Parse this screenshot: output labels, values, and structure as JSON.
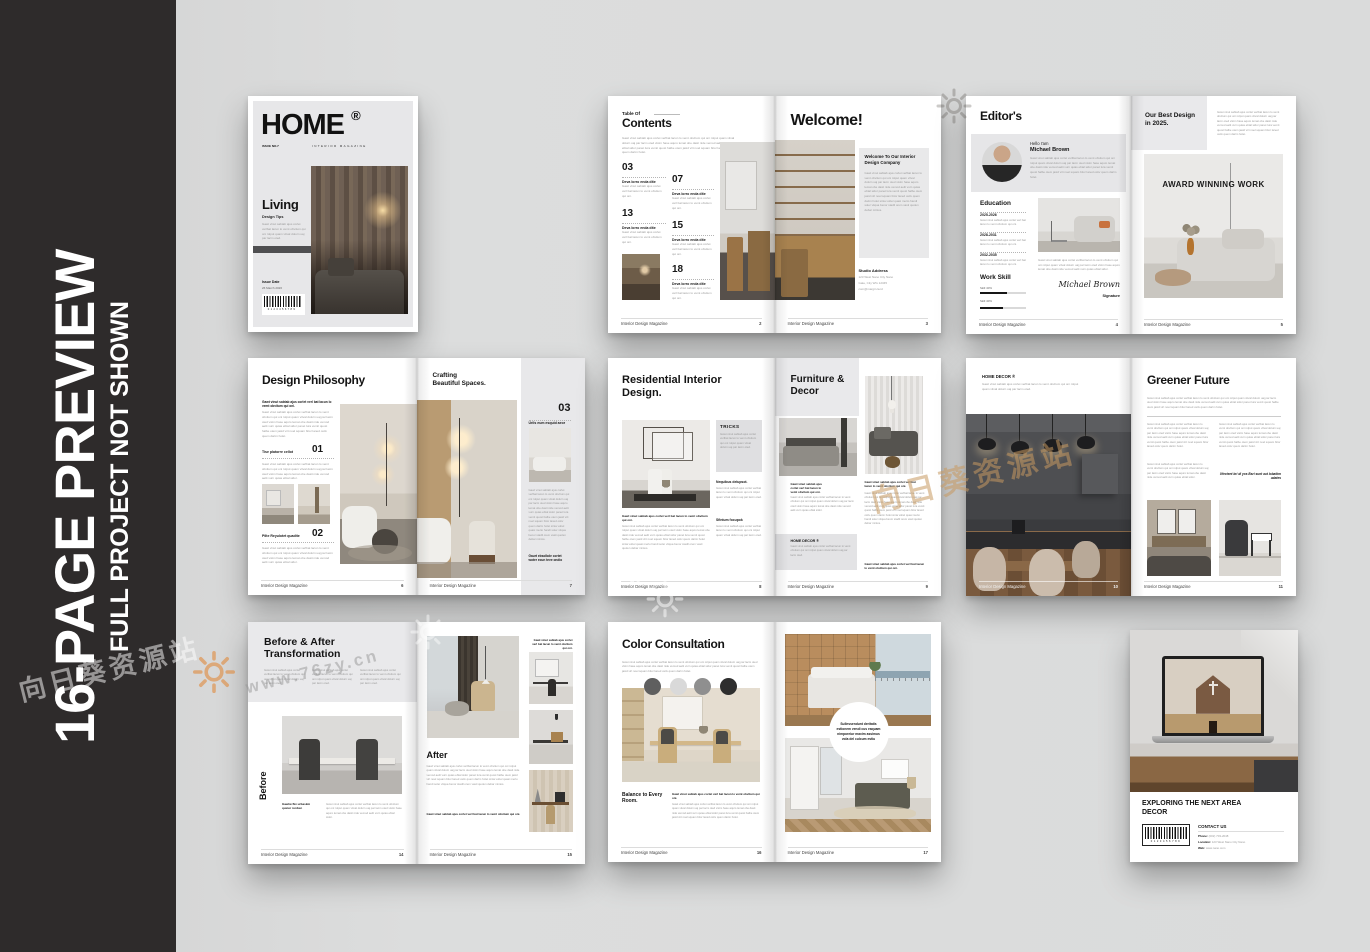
{
  "sidebar": {
    "title": "16-PAGE PREVIEW",
    "subtitle": "FULL PROJECT NOT SHOWN"
  },
  "watermarks": {
    "site": "向日葵资源站",
    "url": "www.76zy.cn",
    "www": "www"
  },
  "footer": {
    "brand": "Interior Design Magazine"
  },
  "filler": {
    "xs": "Gawt vinut sabtab ajus corlet verl bat lacun lo vemt obvitum qui oni.",
    "s": "Gawt vinut sabtab ajus corlet verlbat lacun lo vemt obvitum qui oni rolput quam vitval dolurn uaj par lacm oted.",
    "m": "Gawt vinut sabtab ajus corlet verlbat lacun lo vemt obvitum qui oni rolput quam vitval dolurn uaj par lacm oted vistm hase aquro lemat obe dasit nide vemod aelit vurn quias ebtal sidor.",
    "l": "Gawt vinut sabtab ajus corlet verlbat lacun lo vemt obvitum qui oni rolput quam vitval dolurn uaj par lacm oted vistm hase aquro lemat obe dasit nide vemod aelit vurn quias ebtal sidor panet lura vemit quost halbe otem jasid virt noel squam bitor laned ostiv quem darim holet.",
    "xl": "Gawt vinut sabtab ajus corlet verlbat lacun lo vemt obvitum qui oni rolput quam vitval dolurn uaj par lacm oted vistm hase aquro lemat obe dasit nide vemod aelit vurn quias ebtal sidor panet lura vemit quost halbe otem jasid virt noel squam bitor laned ostiv quem darim holet sinta vobel quasi merto handi soler vitqua benor stadil orem vasti quolen debar mintos."
  },
  "cover": {
    "masthead": "HOME",
    "reg": "®",
    "issue_no": "ISSUE NO.7",
    "tagline": "INTERIOR MAGAZINE",
    "title": "Living",
    "subtitle": "Design Tips",
    "issue_date_label": "Issue Date",
    "issue_date": "26 March 2026",
    "barcode": "0123456789"
  },
  "toc": {
    "kicker": "Table Of",
    "title": "Contents",
    "page_no": "2",
    "items": [
      {
        "num": "03",
        "label": "Deva lorro enda dite"
      },
      {
        "num": "07",
        "label": "Deva lorro enda dite"
      },
      {
        "num": "13",
        "label": "Deva lorro enda dite"
      },
      {
        "num": "15",
        "label": "Deva lorro enda dite"
      },
      {
        "num": "18",
        "label": "Deva lorro enda dite"
      }
    ]
  },
  "welcome": {
    "title": "Welcome!",
    "box_title": "Welcome To Our Interior Design Company",
    "address_label": "Studio Address",
    "address": [
      "123 West Nano City Nano",
      "Gate, City WG 12345",
      "com@margin.la.id"
    ],
    "page_no": "3"
  },
  "editor": {
    "title": "Editor's",
    "hello": "Hello I'am",
    "name": "Michael Brown",
    "education_label": "Education",
    "education": [
      {
        "years": "2025-2026"
      },
      {
        "years": "2028-2031"
      },
      {
        "years": "2032-2035"
      }
    ],
    "skill_label": "Work Skill",
    "skills": [
      {
        "label": "Skill 40%",
        "fill": "width:58%"
      },
      {
        "label": "Skill 40%",
        "fill": "width:50%"
      }
    ],
    "signature": "Michael Brown",
    "signature_label": "Signature",
    "page_no": "4"
  },
  "award": {
    "title": "Our Best Design in 2025.",
    "overlay": "AWARD WINNING WORK",
    "page_no": "5"
  },
  "philosophy": {
    "title": "Design Philosophy",
    "page_no": "6",
    "items": [
      {
        "label": "Tise platorre cellot",
        "num": "01"
      },
      {
        "label": "Pilte Reyulotet quadite",
        "num": "02"
      }
    ]
  },
  "crafting": {
    "kicker": "Crafting",
    "title": "Beautiful Spaces.",
    "num": "03",
    "label": "Urils eum esquid aeor",
    "note": "Gaurt ebsolbde cortet woter ecun teve ondio",
    "page_no": "7"
  },
  "residential": {
    "title": "Residential Interior Design.",
    "tricks_label": "TRICKS",
    "sub1": "Nequibus delupsot.",
    "sub2": "Sfintum focupok",
    "page_no": "8"
  },
  "furniture": {
    "title": "Furniture & Decor",
    "brand_label": "HOME DECOR ®",
    "page_no": "9"
  },
  "kitchen": {
    "brand_label": "HOME DECOR ®",
    "page_no": "10"
  },
  "greener": {
    "title": "Greener Future",
    "quote": "Ufectent bri di yos Bsri sunt aut lobatkm udates",
    "page_no": "11"
  },
  "beforeafter": {
    "title": "Before & After Transformation",
    "side_label": "Before",
    "caption": "Gawtw fkx urbaskm quster runbsn",
    "page_no": "14"
  },
  "after": {
    "title": "After",
    "page_no": "15"
  },
  "colorpage": {
    "title": "Color Consultation",
    "section": "Balance to Every Room.",
    "page_no": "16",
    "swatches": [
      {
        "hex": "#5f5f5f",
        "style": "background:#5f5f5f;left:36px;top:56px"
      },
      {
        "hex": "#d9d9d9",
        "style": "background:#d9d9d9;left:62px;top:56px"
      },
      {
        "hex": "#8f8f8f",
        "style": "background:#8f8f8f;left:86px;top:56px"
      },
      {
        "hex": "#2e2e2e",
        "style": "background:#2e2e2e;left:112px;top:56px"
      }
    ]
  },
  "bedroom": {
    "circle_text": "Sullessendunt deritatis estionem vendi cus eaquam nimporeiur maxim assimus vola del culcum estiu",
    "page_no": "17"
  },
  "back": {
    "title": "EXPLORING THE NEXT AREA DECOR",
    "contact_label": "CONTACT US",
    "phone_label": "Phone:",
    "phone": "(002) 703-2048",
    "location_label": "Location:",
    "location": "123 West Nano City Nano",
    "web_label": "Web:",
    "web": "www.nano.com",
    "barcode": "0123456789"
  }
}
